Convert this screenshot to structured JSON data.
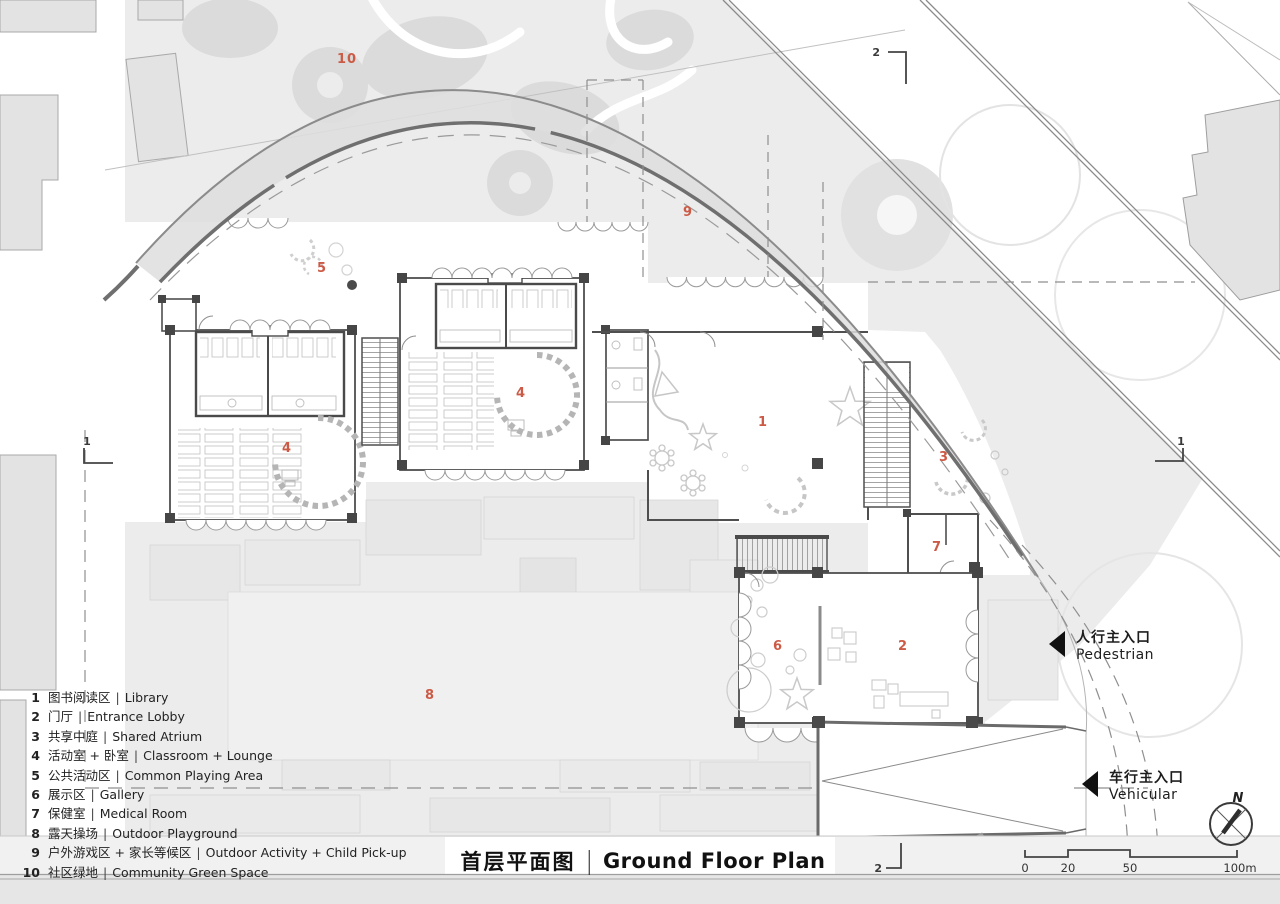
{
  "drawing": {
    "title": {
      "zh": "首层平面图",
      "divider": "|",
      "en": "Ground Floor Plan"
    },
    "legend": {
      "separator": "|",
      "items": [
        {
          "num": "1",
          "zh": "图书阅读区",
          "en": "Library"
        },
        {
          "num": "2",
          "zh": "门厅",
          "en": "Entrance Lobby"
        },
        {
          "num": "3",
          "zh": "共享中庭",
          "en": "Shared Atrium"
        },
        {
          "num": "4",
          "zh": "活动室 + 卧室",
          "en": "Classroom + Lounge"
        },
        {
          "num": "5",
          "zh": "公共活动区",
          "en": "Common Playing Area"
        },
        {
          "num": "6",
          "zh": "展示区",
          "en": "Gallery"
        },
        {
          "num": "7",
          "zh": "保健室",
          "en": "Medical Room"
        },
        {
          "num": "8",
          "zh": "露天操场",
          "en": "Outdoor Playground"
        },
        {
          "num": "9",
          "zh": "户外游戏区 + 家长等候区",
          "en": "Outdoor Activity + Child Pick-up"
        },
        {
          "num": "10",
          "zh": "社区绿地",
          "en": "Community Green Space"
        }
      ]
    },
    "annotations": {
      "north_label": "N",
      "scale_ticks": [
        "0",
        "20",
        "50",
        "100m"
      ],
      "section_markers": {
        "top": "2",
        "bottom": "2",
        "left": "1",
        "right": "1"
      },
      "entrances": {
        "pedestrian": {
          "zh": "人行主入口",
          "en": "Pedestrian"
        },
        "vehicular": {
          "zh": "车行主入口",
          "en": "Vehicular"
        }
      },
      "area_labels": [
        "10",
        "9",
        "5",
        "4",
        "1",
        "4",
        "3",
        "7",
        "6",
        "2",
        "8"
      ]
    },
    "colors": {
      "accent_red": "#cb5b46",
      "wall": "#4f4f4f",
      "site_gray": "#ececec",
      "canopy": "#dedede"
    }
  }
}
